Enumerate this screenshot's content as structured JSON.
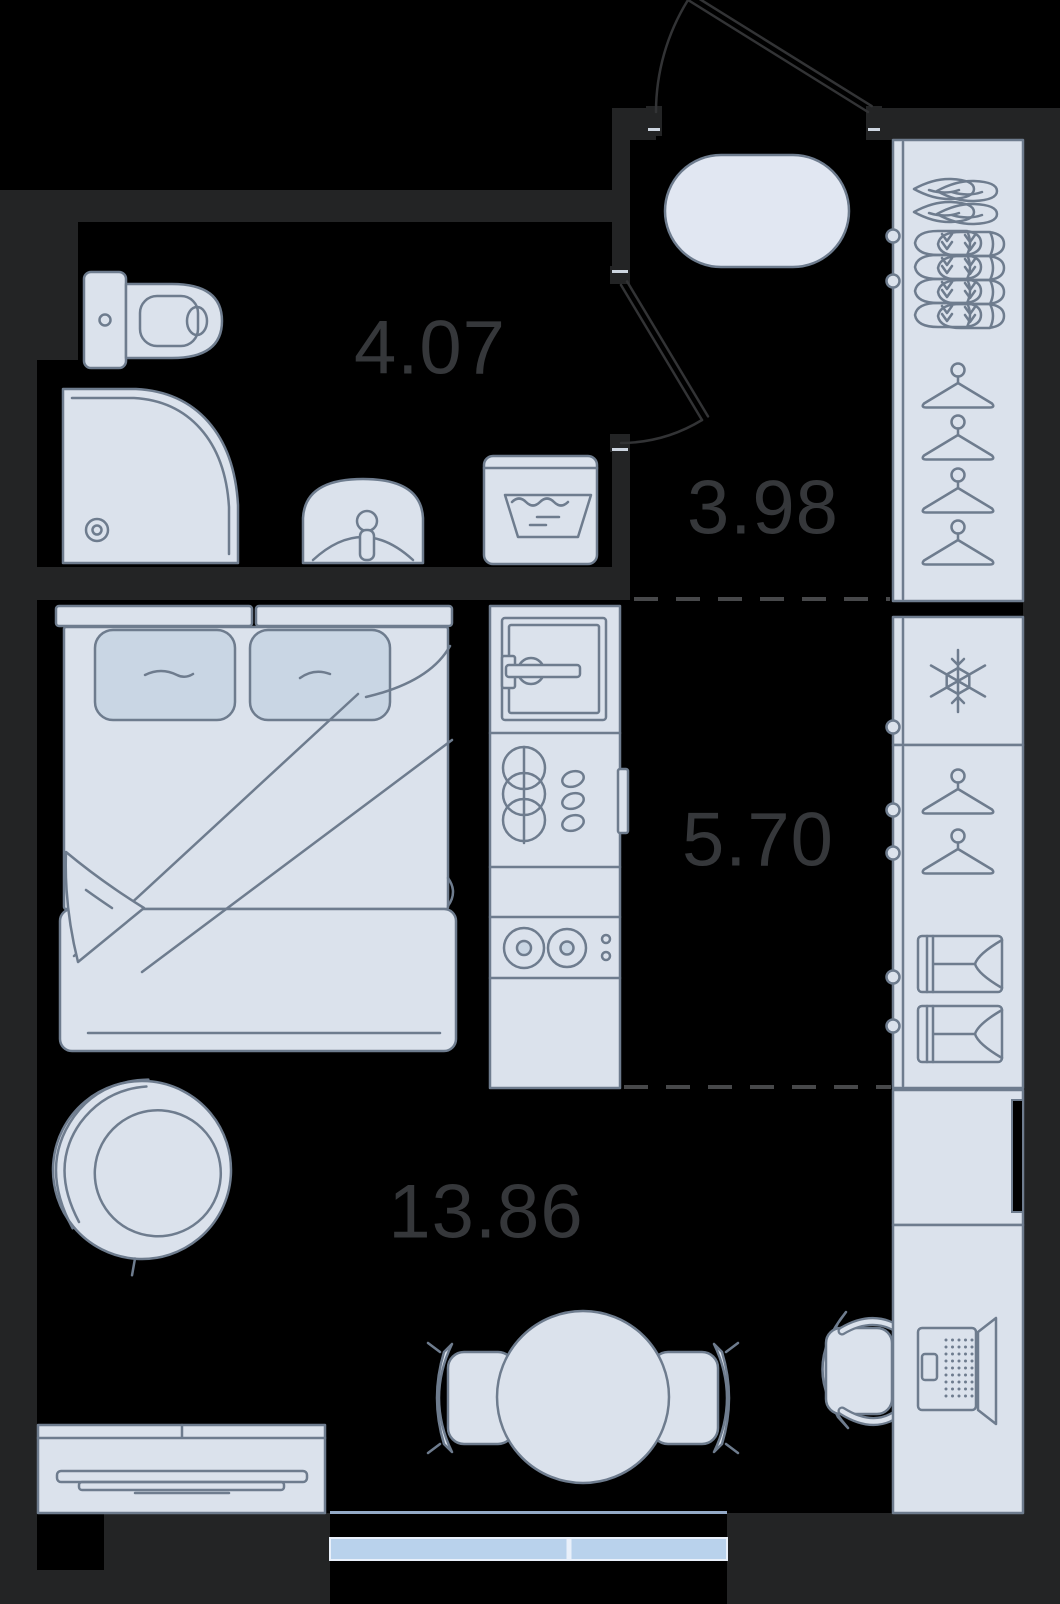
{
  "rooms": {
    "bathroom": {
      "area": "4.07"
    },
    "hallway": {
      "area": "3.98"
    },
    "kitchen": {
      "area": "5.70"
    },
    "living": {
      "area": "13.86"
    }
  },
  "colors": {
    "background": "#000000",
    "wall": "#232425",
    "furniture": "#dbe2ec",
    "furniture_dark": "#c9d6e4",
    "rug": "#e1e7f2",
    "outline": "#6e7c8e",
    "label": "#35373a",
    "door": "#323335",
    "dash": "#47484a",
    "window": "#b9d2ec"
  },
  "icons": {
    "fridge": "snowflake-icon",
    "washing_machine": "laundry-tub-icon",
    "wardrobe": "hanger-icon, shoes-icon, folded-clothes-icon",
    "workspace": "laptop-icon"
  }
}
